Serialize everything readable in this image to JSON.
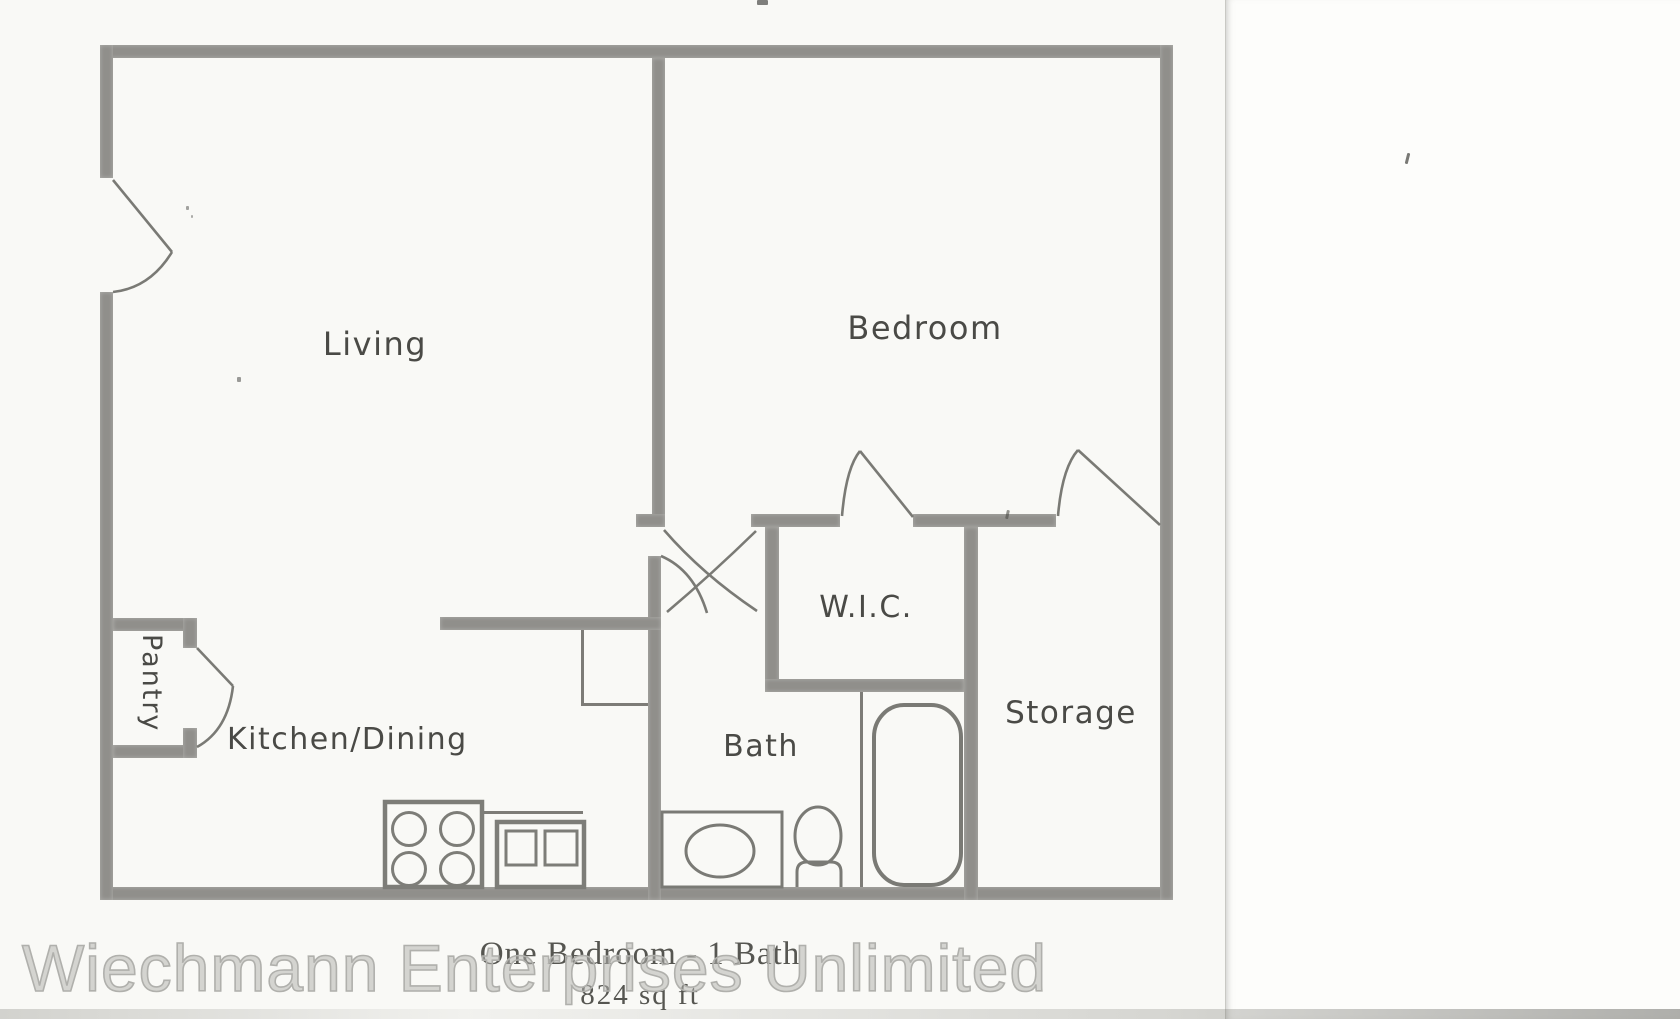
{
  "document": {
    "type_caption": "One Bedroom - 1 Bath",
    "area_caption": "824 sq ft",
    "watermark": "Wiechmann Enterprises Unlimited"
  },
  "floor_plan": {
    "rooms": {
      "living": {
        "label": "Living"
      },
      "bedroom": {
        "label": "Bedroom"
      },
      "wic": {
        "label": "W.I.C."
      },
      "storage": {
        "label": "Storage"
      },
      "bath": {
        "label": "Bath"
      },
      "kitchen_dining": {
        "label": "Kitchen/Dining"
      },
      "pantry": {
        "label": "Pantry"
      }
    },
    "fixtures": [
      "stove",
      "kitchen-double-sink",
      "vanity-sink",
      "toilet",
      "bathtub"
    ],
    "colors": {
      "wall": "#908f8b",
      "fixture_line": "#7a7a75",
      "label_text": "#4a4a46"
    }
  }
}
